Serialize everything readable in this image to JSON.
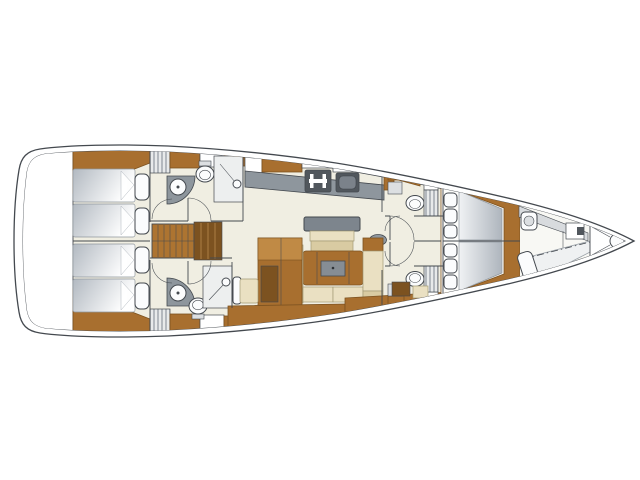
{
  "meta": {
    "title": "Sailing yacht interior deck plan — top view, bow to the right",
    "type": "boat-floor-plan",
    "orientation": "bow-right"
  },
  "colors": {
    "line": "#44494f",
    "floor": "#f0eee2",
    "wood": "#a86f2f",
    "wood-dark": "#7c5220",
    "wood-light": "#c08a45",
    "stairs": "#ad7431",
    "counter": "#8e969d",
    "appliance": "#51575d",
    "backrest": "#7d858d",
    "beige": "#eae0c2",
    "beige-dark": "#d9cba2",
    "beige-edge": "#a39a76",
    "locker-gray": "#dcdfe2",
    "shelf-gray": "#d8dbde",
    "shower-gray": "#edefef",
    "mattress-dark": "#b2b9c1",
    "vberth-dark": "#aeb5bd",
    "vberth-light": "#f0f2f4",
    "pillow": "#fbfcfd",
    "hatch-bg": "#e8eaeb",
    "hatch-line": "#9298a0"
  },
  "legend": {
    "zones": [
      "swim platform / transom locker",
      "aft cabin port with 2 berths",
      "aft cabin starboard with 2 berths",
      "aft head port with basin, toilet and shower",
      "aft head starboard with basin, toilet and shower",
      "companionway steps",
      "galley with stove and sink",
      "saloon with table, settees, seat bench and pouf",
      "forward head port",
      "forward head starboard",
      "owner's cabin with V-berth",
      "forepeak with basin and berth",
      "anchor locker at bow"
    ],
    "fixture_counts": {
      "aft_berths": 4,
      "v_berth_double": 1,
      "forepeak_berth": 1,
      "toilets": 4,
      "washbasins": 3,
      "showers": 2,
      "stove": 1,
      "galley_sink": 1,
      "saloon_table": 1,
      "companionway_stairs": 1,
      "portlight_circles": 4
    }
  }
}
